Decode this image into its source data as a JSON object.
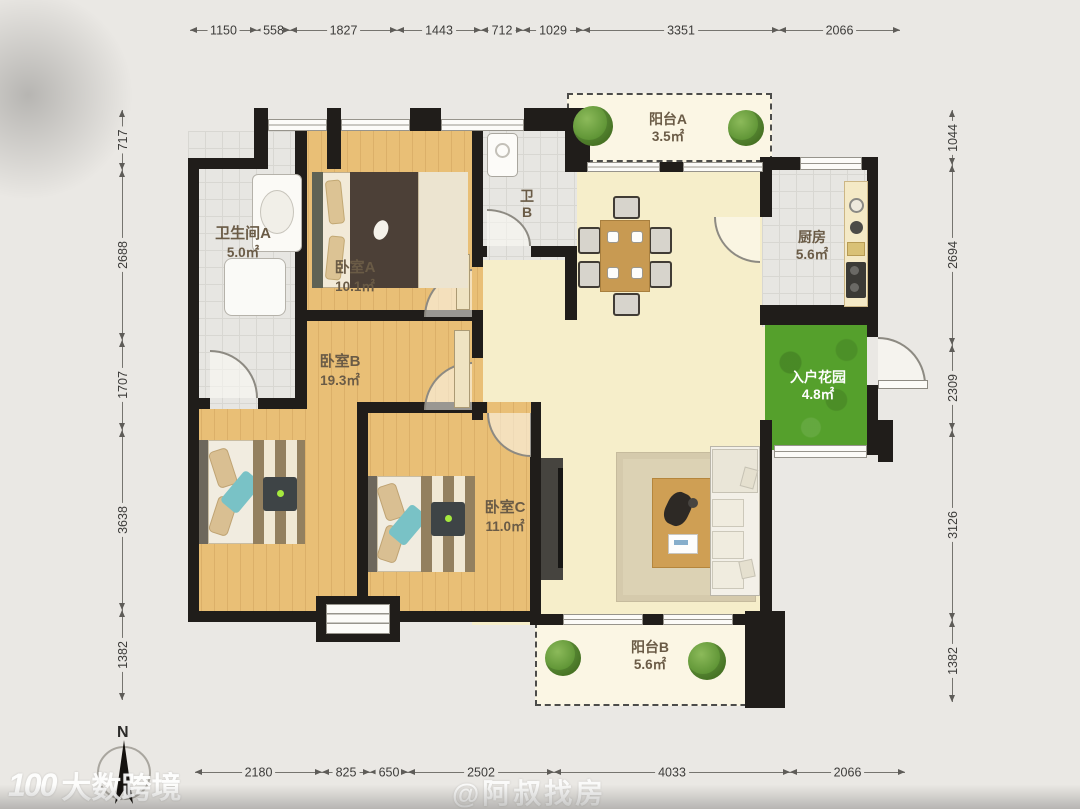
{
  "rooms": [
    {
      "id": "bathroom-a",
      "name": "卫生间A",
      "area": "5.0㎡"
    },
    {
      "id": "bedroom-a",
      "name": "卧室A",
      "area": "10.1㎡"
    },
    {
      "id": "bedroom-b",
      "name": "卧室B",
      "area": "19.3㎡"
    },
    {
      "id": "bedroom-c",
      "name": "卧室C",
      "area": "11.0㎡"
    },
    {
      "id": "bathroom-b",
      "name": "卫B",
      "area": ""
    },
    {
      "id": "balcony-a",
      "name": "阳台A",
      "area": "3.5㎡"
    },
    {
      "id": "kitchen",
      "name": "厨房",
      "area": "5.6㎡"
    },
    {
      "id": "entry-garden",
      "name": "入户花园",
      "area": "4.8㎡"
    },
    {
      "id": "balcony-b",
      "name": "阳台B",
      "area": "5.6㎡"
    }
  ],
  "dimensions": {
    "top": [
      "1150",
      "558",
      "1827",
      "1443",
      "712",
      "1029",
      "3351",
      "2066"
    ],
    "bottom": [
      "2180",
      "825",
      "650",
      "2502",
      "4033",
      "2066"
    ],
    "left": [
      "717",
      "2688",
      "1707",
      "3638",
      "1382"
    ],
    "right": [
      "1044",
      "2694",
      "2309",
      "3126",
      "1382"
    ]
  },
  "compass": {
    "label": "N"
  },
  "watermarks": {
    "brand_logo": "100",
    "brand": "大数跨境",
    "center": "@阿叔找房"
  },
  "colors": {
    "wall": "#201d1a",
    "wood_floor": "#e9bf76",
    "living_floor": "#f6eeca",
    "tile_floor": "#e7e6e2",
    "garden": "#55a02c",
    "page_bg": "#eae8e4"
  }
}
